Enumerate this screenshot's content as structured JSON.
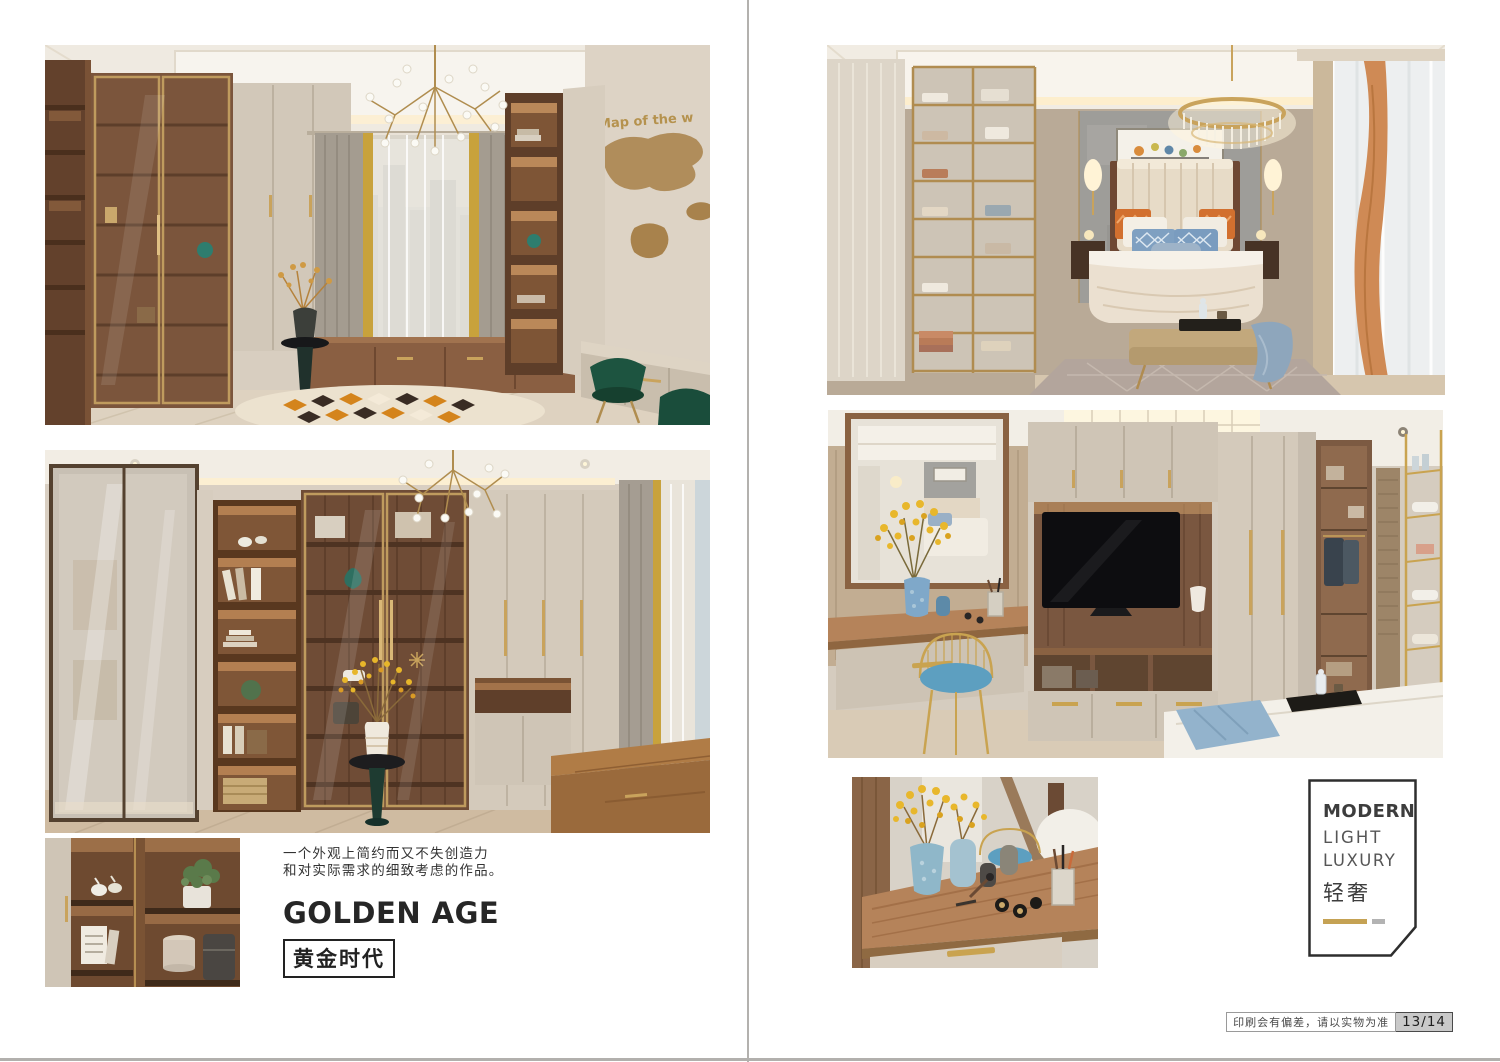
{
  "left_page": {
    "intro": [
      "一个外观上简约而又不失创造力",
      "和对实际需求的细致考虑的作品。"
    ],
    "title_en": "GOLDEN AGE",
    "title_cn": "黄金时代"
  },
  "right_page": {
    "style_label": {
      "en": [
        "MODERN",
        "LIGHT",
        "LUXURY"
      ],
      "cn": "轻奢"
    }
  },
  "footer": {
    "disclaimer": "印刷会有偏差，请以实物为准",
    "page_number": "13/14"
  },
  "photo_text": {
    "map_wall": "Map of the w"
  },
  "colors": {
    "page_bg": "#ffffff",
    "divider_gray": "#b3b1ae",
    "accent_gold": "#c5a254",
    "wood_brown": "#7a5740",
    "beige_panel": "#d2c8b9",
    "emerald_chair": "#1d5440",
    "rug_orange": "#d4841c",
    "pillow_blue": "#7fa0c1",
    "pillow_orange": "#d2702f"
  }
}
